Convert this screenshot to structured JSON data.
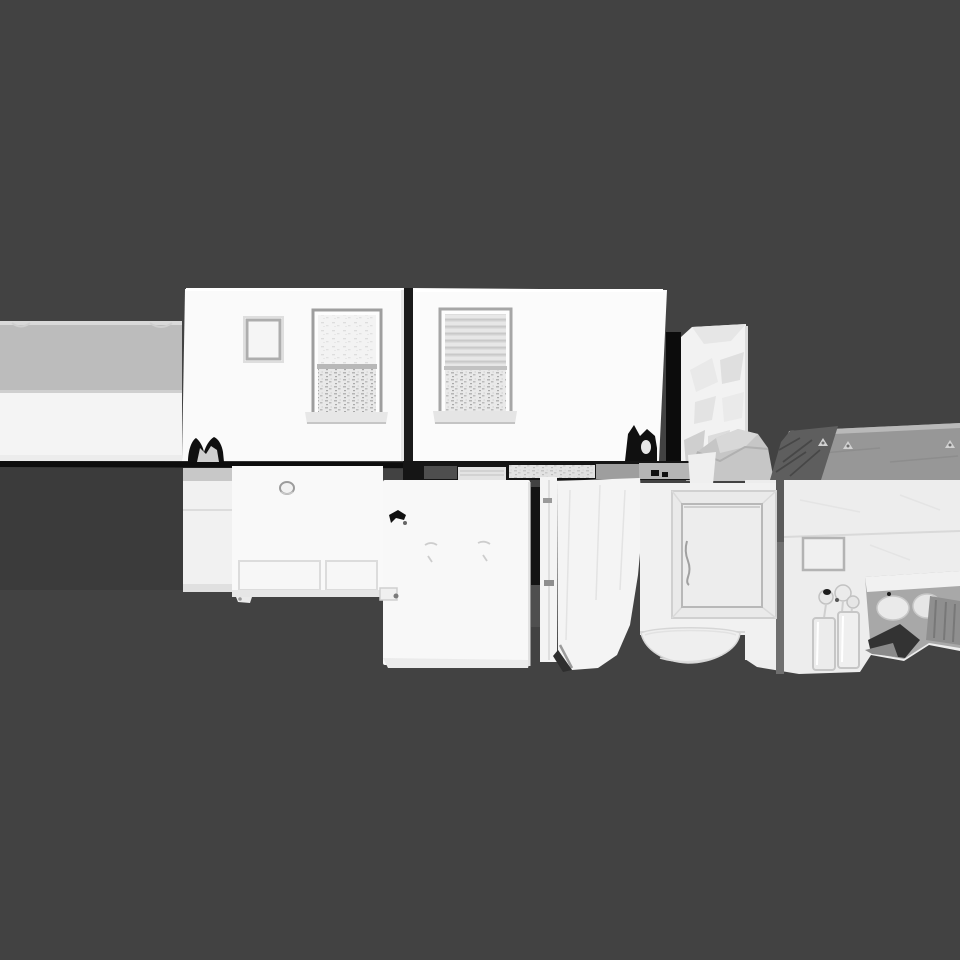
{
  "scene": {
    "type": "3d-mesh-render",
    "description": "Grayscale photogrammetry mesh of a kitchen interior viewed from outside, floating on a flat dark gray background. No text, toolbars or UI chrome are visible.",
    "background_color": "#424242",
    "objects": [
      {
        "id": "left-countertop-slab",
        "label": "long countertop slab exiting frame left"
      },
      {
        "id": "floor-shadow",
        "label": "dark shadow under left slab"
      },
      {
        "id": "baseline-trim",
        "label": "black floor edge line"
      },
      {
        "id": "wall-module-1",
        "label": "white wall module with small window and large scanned window"
      },
      {
        "id": "wall-module-2",
        "label": "white wall module with blinds window"
      },
      {
        "id": "textured-pillar",
        "label": "crumpled white pillar"
      },
      {
        "id": "fabric-drape",
        "label": "gray crumpled drape over counter corner"
      },
      {
        "id": "kitchen-counter",
        "label": "gray countertop with dark beveled edge and small objects"
      },
      {
        "id": "right-cabinet-face",
        "label": "white cabinet face with switch plate, seam bar and under-counter recess"
      },
      {
        "id": "glassware",
        "label": "faucet and glasses in front of recess"
      },
      {
        "id": "lower-cabinet",
        "label": "lower cabinets with knob and two drawers"
      },
      {
        "id": "appliance-panel",
        "label": "large flat appliance panel with dark scuff mark"
      },
      {
        "id": "mid-door-frame",
        "label": "vertical door frame strips and crumpled panel"
      },
      {
        "id": "cabinet-door",
        "label": "beveled recessed cabinet door"
      },
      {
        "id": "extractor-bowl",
        "label": "bowl shaped dome under cabinet"
      }
    ]
  },
  "palette": {
    "bg": "#424242",
    "floor_shadow": "#3b3b3b",
    "edge_black": "#0d0d0d",
    "gap_black": "#1a1a1a",
    "module_white": "#fafafa",
    "module_white2": "#fbfbfb",
    "slab_gray": "#bcbcbc",
    "slab_white": "#f4f4f4",
    "window_frame": "#9e9e9e",
    "sill": "#e7e7e7",
    "pillar_white": "#f2f2f2",
    "drape": "#c6c6c6",
    "counter": "#979797",
    "counter_edge": "#b9b9b9",
    "wedge": "#5e5e5e",
    "face_white": "#ededed",
    "seam": "#6f6f6f",
    "plate_fill": "#f0f0f0",
    "plate_stroke": "#b3b3b3",
    "recess": "#a8a8a8",
    "recess_dark": "#333333",
    "cab_side": "#f1f1f1",
    "cab_cap": "#c8c8c8",
    "cab_front": "#f9f9f9",
    "appliance": "#f8f8f8",
    "midframe": "#f4f4f4",
    "doorcab": "#f1f1f1",
    "bevel": "#eaeaea",
    "door": "#ededed",
    "door_stroke": "#b8b8b8",
    "bowl": "#efefef",
    "seg_dark": "#4e4e4e",
    "seg_light": "#e3e3e3",
    "seg_speckle": "#d9d9d9",
    "seg_gray": "#9e9e9e",
    "seg_gray2": "#b5b5b5",
    "glass": "#ececec",
    "knob": "#9c9c9c",
    "blob_black": "#0f0f0f"
  }
}
